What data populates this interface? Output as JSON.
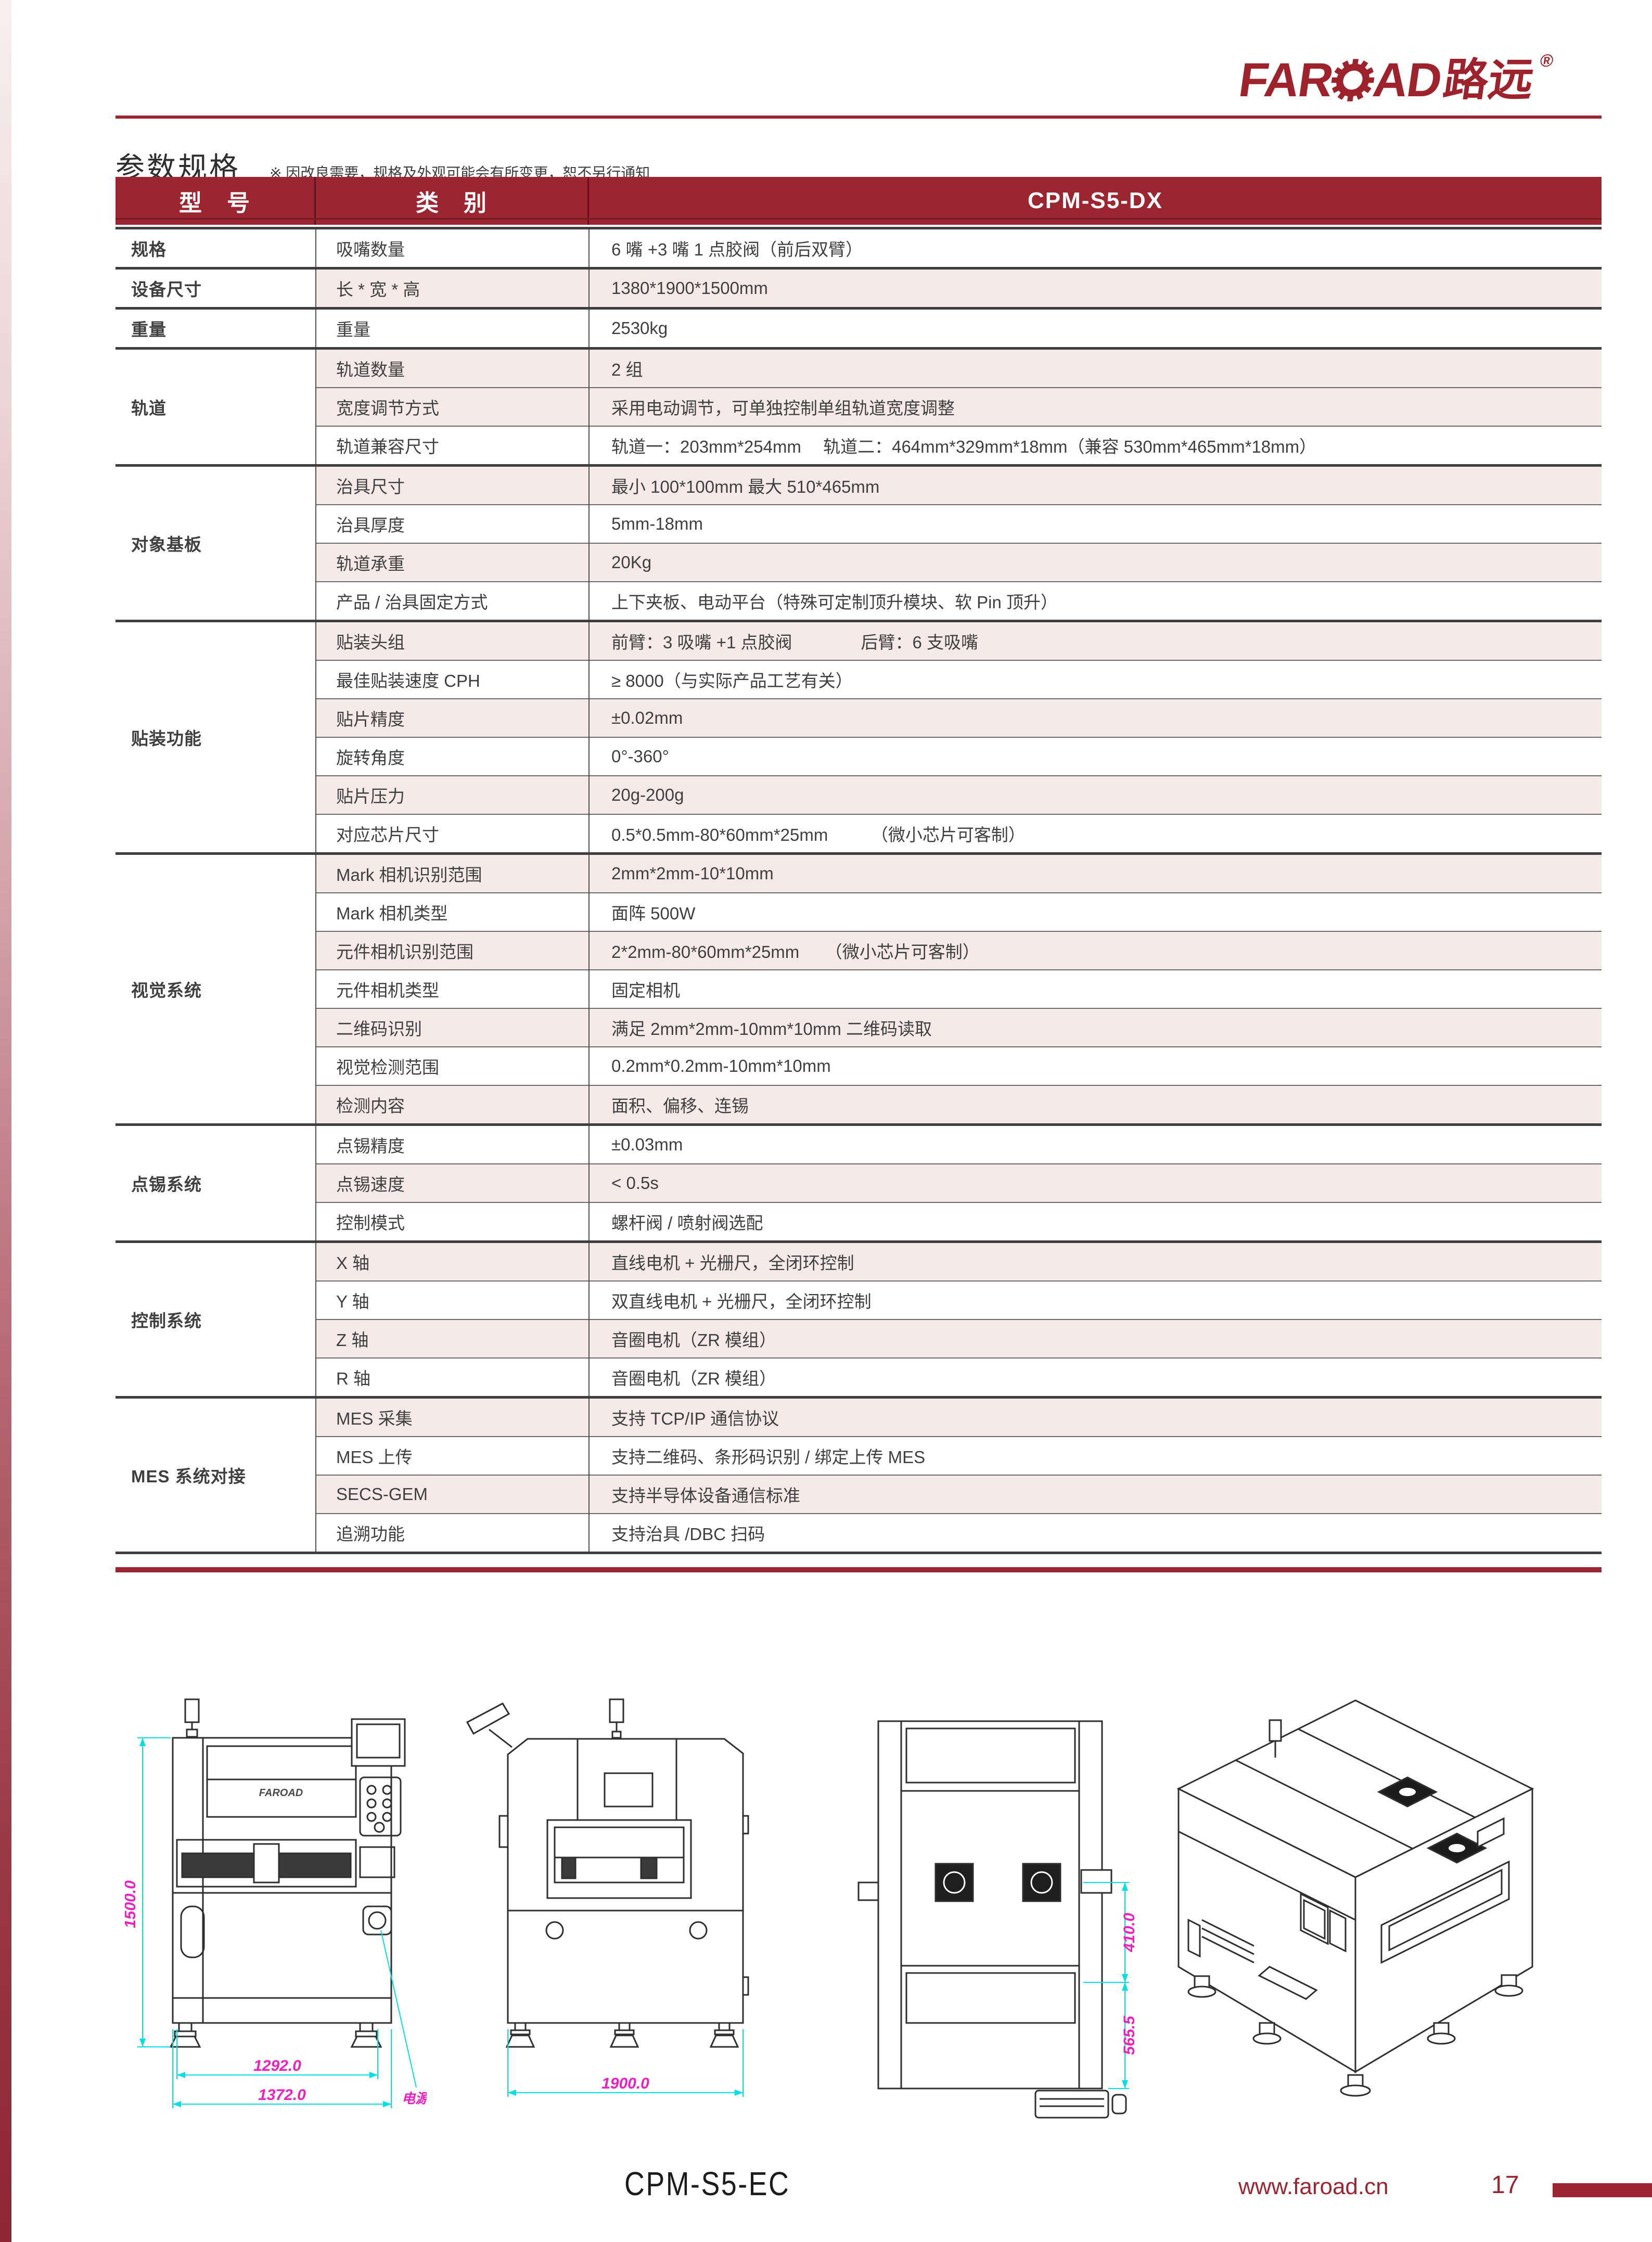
{
  "logo": {
    "latin_left": "FAR",
    "latin_right": "AD",
    "cn": "路远",
    "registered": "®"
  },
  "title": "参数规格",
  "title_note": "※ 因改良需要，规格及外观可能会有所变更，恕不另行通知",
  "table": {
    "header": {
      "col1": "型　号",
      "col2": "类　别",
      "col3": "CPM-S5-DX"
    },
    "groups": [
      {
        "name": "规格",
        "rows": [
          {
            "label": "吸嘴数量",
            "value": "6 嘴 +3 嘴 1 点胶阀（前后双臂）",
            "shade": false
          }
        ]
      },
      {
        "name": "设备尺寸",
        "rows": [
          {
            "label": "长 * 宽 * 高",
            "value": "1380*1900*1500mm",
            "shade": true
          }
        ]
      },
      {
        "name": "重量",
        "rows": [
          {
            "label": "重量",
            "value": "2530kg",
            "shade": false
          }
        ]
      },
      {
        "name": "轨道",
        "rows": [
          {
            "label": "轨道数量",
            "value": "2 组",
            "shade": true
          },
          {
            "label": "宽度调节方式",
            "value": "采用电动调节，可单独控制单组轨道宽度调整",
            "shade": true
          },
          {
            "label": "轨道兼容尺寸",
            "value": "轨道一：203mm*254mm　 轨道二：464mm*329mm*18mm（兼容 530mm*465mm*18mm）",
            "shade": false
          }
        ]
      },
      {
        "name": "对象基板",
        "rows": [
          {
            "label": "治具尺寸",
            "value": "最小 100*100mm  最大 510*465mm",
            "shade": true
          },
          {
            "label": "治具厚度",
            "value": "5mm-18mm",
            "shade": false
          },
          {
            "label": "轨道承重",
            "value": "20Kg",
            "shade": true
          },
          {
            "label": "产品 / 治具固定方式",
            "value": "上下夹板、电动平台（特殊可定制顶升模块、软 Pin 顶升）",
            "shade": false
          }
        ]
      },
      {
        "name": "贴装功能",
        "rows": [
          {
            "label": "贴装头组",
            "value": "前臂：3 吸嘴 +1 点胶阀　　　　后臂：6 支吸嘴",
            "shade": true
          },
          {
            "label": "最佳贴装速度 CPH",
            "value": "≥ 8000（与实际产品工艺有关）",
            "shade": false
          },
          {
            "label": "贴片精度",
            "value": "±0.02mm",
            "shade": true
          },
          {
            "label": "旋转角度",
            "value": "0°-360°",
            "shade": false
          },
          {
            "label": "贴片压力",
            "value": "20g-200g",
            "shade": true
          },
          {
            "label": "对应芯片尺寸",
            "value": "0.5*0.5mm-80*60mm*25mm　　　（微小芯片可客制）",
            "shade": false
          }
        ]
      },
      {
        "name": "视觉系统",
        "rows": [
          {
            "label": "Mark 相机识别范围",
            "value": "2mm*2mm-10*10mm",
            "shade": true
          },
          {
            "label": "Mark 相机类型",
            "value": "面阵 500W",
            "shade": false
          },
          {
            "label": "元件相机识别范围",
            "value": "2*2mm-80*60mm*25mm　　（微小芯片可客制）",
            "shade": true
          },
          {
            "label": "元件相机类型",
            "value": "固定相机",
            "shade": false
          },
          {
            "label": "二维码识别",
            "value": "满足 2mm*2mm-10mm*10mm 二维码读取",
            "shade": true
          },
          {
            "label": "视觉检测范围",
            "value": "0.2mm*0.2mm-10mm*10mm",
            "shade": false
          },
          {
            "label": "检测内容",
            "value": "面积、偏移、连锡",
            "shade": true
          }
        ]
      },
      {
        "name": "点锡系统",
        "rows": [
          {
            "label": "点锡精度",
            "value": "±0.03mm",
            "shade": false
          },
          {
            "label": "点锡速度",
            "value": "< 0.5s",
            "shade": true
          },
          {
            "label": "控制模式",
            "value": "螺杆阀 / 喷射阀选配",
            "shade": false
          }
        ]
      },
      {
        "name": "控制系统",
        "rows": [
          {
            "label": "X 轴",
            "value": "直线电机 + 光栅尺，全闭环控制",
            "shade": true
          },
          {
            "label": "Y 轴",
            "value": "双直线电机 + 光栅尺，全闭环控制",
            "shade": false
          },
          {
            "label": "Z 轴",
            "value": "音圈电机（ZR 模组）",
            "shade": true
          },
          {
            "label": "R 轴",
            "value": "音圈电机（ZR 模组）",
            "shade": false
          }
        ]
      },
      {
        "name": "MES 系统对接",
        "rows": [
          {
            "label": "MES 采集",
            "value": "支持 TCP/IP 通信协议",
            "shade": true
          },
          {
            "label": "MES 上传",
            "value": "支持二维码、条形码识别 / 绑定上传 MES",
            "shade": false
          },
          {
            "label": "SECS-GEM",
            "value": "支持半导体设备通信标准",
            "shade": true
          },
          {
            "label": "追溯功能",
            "value": "支持治具 /DBC 扫码",
            "shade": false
          }
        ]
      }
    ]
  },
  "drawings": {
    "front_view": {
      "brand_mark": "FAROAD",
      "height_dim": "1500.0",
      "inner_width_dim": "1292.0",
      "outer_width_dim": "1372.0",
      "power_label": "电源"
    },
    "side_view": {
      "depth_dim": "1900.0"
    },
    "top_view": {
      "upper_dim": "410.0",
      "lower_dim": "565.5"
    }
  },
  "footer": {
    "model": "CPM-S5-EC",
    "website": "www.faroad.cn",
    "page_number": "17"
  },
  "colors": {
    "brand_red": "#9b2530",
    "row_shade": "#f6eae9",
    "dim_line_cyan": "#00dfe4",
    "dim_text_magenta": "#ee1fc0"
  }
}
